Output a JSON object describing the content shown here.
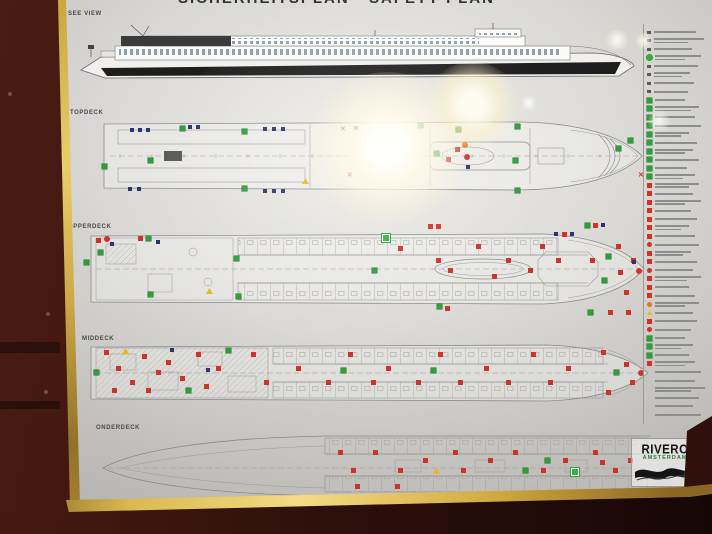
{
  "poster": {
    "title": "SICHERHEITSPLAN · SAFETY PLAN",
    "side_view_label": "SEE VIEW",
    "logo": {
      "line1": "RIVERO",
      "line2": "AMSTERDAM"
    },
    "decks": [
      {
        "id": "topdeck",
        "label": "TOPDECK",
        "icons": [
          [
            "b",
            30,
            10
          ],
          [
            "b",
            38,
            10
          ],
          [
            "b",
            46,
            10
          ],
          [
            "g",
            80,
            8
          ],
          [
            "b",
            88,
            7
          ],
          [
            "b",
            96,
            7
          ],
          [
            "g",
            142,
            11
          ],
          [
            "b",
            163,
            9
          ],
          [
            "b",
            172,
            9
          ],
          [
            "b",
            181,
            9
          ],
          [
            "x",
            240,
            8
          ],
          [
            "b",
            254,
            8
          ],
          [
            "g",
            318,
            5
          ],
          [
            "g",
            356,
            9
          ],
          [
            "g",
            415,
            6
          ],
          [
            "o",
            362,
            24
          ],
          [
            "R",
            364,
            36
          ],
          [
            "b",
            366,
            47
          ],
          [
            "g",
            334,
            33
          ],
          [
            "r",
            346,
            39
          ],
          [
            "r",
            355,
            29
          ],
          [
            "g",
            415,
            70
          ],
          [
            "g",
            142,
            68
          ],
          [
            "b",
            28,
            69
          ],
          [
            "b",
            37,
            69
          ],
          [
            "b",
            163,
            71
          ],
          [
            "b",
            172,
            71
          ],
          [
            "b",
            181,
            71
          ],
          [
            "y",
            202,
            60
          ],
          [
            "g",
            2,
            46
          ],
          [
            "g",
            48,
            40
          ],
          [
            "x",
            247,
            54
          ],
          [
            "g",
            516,
            28
          ],
          [
            "g",
            413,
            40
          ],
          [
            "g",
            528,
            20
          ],
          [
            "x",
            538,
            54
          ]
        ]
      },
      {
        "id": "opperdeck",
        "label": "OPPERDECK",
        "icons": [
          [
            "r",
            8,
            8
          ],
          [
            "R",
            16,
            6
          ],
          [
            "g",
            10,
            20
          ],
          [
            "b",
            22,
            12
          ],
          [
            "r",
            50,
            6
          ],
          [
            "g",
            58,
            6
          ],
          [
            "b",
            68,
            10
          ],
          [
            "g",
            60,
            62
          ],
          [
            "g",
            -4,
            30
          ],
          [
            "y",
            118,
            58
          ],
          [
            "g",
            146,
            26
          ],
          [
            "g",
            148,
            64
          ],
          [
            "G",
            294,
            4
          ],
          [
            "r",
            310,
            16
          ],
          [
            "r",
            348,
            28
          ],
          [
            "r",
            388,
            14
          ],
          [
            "r",
            418,
            28
          ],
          [
            "r",
            452,
            14
          ],
          [
            "r",
            468,
            28
          ],
          [
            "r",
            502,
            28
          ],
          [
            "r",
            528,
            14
          ],
          [
            "r",
            543,
            28
          ],
          [
            "b",
            466,
            2
          ],
          [
            "r",
            474,
            2
          ],
          [
            "b",
            482,
            2
          ],
          [
            "r",
            340,
            -6
          ],
          [
            "r",
            348,
            -6
          ],
          [
            "g",
            497,
            -7
          ],
          [
            "r",
            505,
            -7
          ],
          [
            "b",
            513,
            -7
          ],
          [
            "g",
            349,
            74
          ],
          [
            "r",
            357,
            76
          ],
          [
            "r",
            520,
            80
          ],
          [
            "g",
            500,
            80
          ],
          [
            "r",
            538,
            80
          ],
          [
            "g",
            514,
            48
          ],
          [
            "r",
            530,
            40
          ],
          [
            "r",
            536,
            60
          ],
          [
            "b",
            544,
            30
          ],
          [
            "R",
            548,
            38
          ],
          [
            "g",
            518,
            24
          ],
          [
            "r",
            360,
            38
          ],
          [
            "g",
            284,
            38
          ],
          [
            "r",
            404,
            44
          ],
          [
            "r",
            440,
            38
          ]
        ]
      },
      {
        "id": "middeck",
        "label": "MIDDECK",
        "icons": [
          [
            "r",
            16,
            8
          ],
          [
            "r",
            28,
            24
          ],
          [
            "r",
            42,
            38
          ],
          [
            "r",
            54,
            12
          ],
          [
            "r",
            68,
            28
          ],
          [
            "r",
            24,
            46
          ],
          [
            "r",
            58,
            46
          ],
          [
            "r",
            78,
            18
          ],
          [
            "r",
            92,
            34
          ],
          [
            "r",
            108,
            10
          ],
          [
            "r",
            116,
            42
          ],
          [
            "r",
            128,
            24
          ],
          [
            "g",
            6,
            28
          ],
          [
            "g",
            98,
            46
          ],
          [
            "g",
            138,
            6
          ],
          [
            "y",
            34,
            6
          ],
          [
            "b",
            82,
            6
          ],
          [
            "b",
            118,
            26
          ],
          [
            "r",
            163,
            10
          ],
          [
            "r",
            176,
            38
          ],
          [
            "r",
            208,
            24
          ],
          [
            "r",
            238,
            38
          ],
          [
            "r",
            260,
            10
          ],
          [
            "r",
            283,
            38
          ],
          [
            "r",
            298,
            24
          ],
          [
            "r",
            328,
            38
          ],
          [
            "r",
            350,
            10
          ],
          [
            "r",
            370,
            38
          ],
          [
            "r",
            396,
            24
          ],
          [
            "r",
            418,
            38
          ],
          [
            "r",
            443,
            10
          ],
          [
            "r",
            460,
            38
          ],
          [
            "r",
            478,
            24
          ],
          [
            "g",
            253,
            26
          ],
          [
            "g",
            343,
            26
          ],
          [
            "r",
            513,
            8
          ],
          [
            "g",
            526,
            28
          ],
          [
            "r",
            518,
            48
          ],
          [
            "r",
            536,
            20
          ],
          [
            "r",
            542,
            38
          ],
          [
            "R",
            550,
            28
          ]
        ]
      },
      {
        "id": "onderdeck",
        "label": "ONDERDECK",
        "icons": [
          [
            "r",
            243,
            20
          ],
          [
            "r",
            256,
            38
          ],
          [
            "r",
            278,
            20
          ],
          [
            "r",
            303,
            38
          ],
          [
            "r",
            328,
            28
          ],
          [
            "r",
            358,
            20
          ],
          [
            "r",
            366,
            38
          ],
          [
            "r",
            393,
            28
          ],
          [
            "r",
            418,
            20
          ],
          [
            "r",
            446,
            38
          ],
          [
            "r",
            468,
            28
          ],
          [
            "r",
            498,
            20
          ],
          [
            "r",
            505,
            30
          ],
          [
            "r",
            518,
            38
          ],
          [
            "r",
            533,
            28
          ],
          [
            "g",
            428,
            38
          ],
          [
            "g",
            450,
            28
          ],
          [
            "G",
            476,
            38
          ],
          [
            "y",
            338,
            38
          ],
          [
            "r",
            260,
            54
          ],
          [
            "r",
            300,
            54
          ]
        ]
      }
    ],
    "legend": {
      "rows": [
        {
          "t": "d",
          "w": 42
        },
        {
          "t": "d",
          "w": 50,
          "w2": 34
        },
        {
          "t": "d",
          "w": 38
        },
        {
          "t": "G",
          "w": 46,
          "w2": 30
        },
        {
          "t": "d",
          "w": 44
        },
        {
          "t": "d",
          "w": 36,
          "w2": 28
        },
        {
          "t": "d",
          "w": 40
        },
        {
          "t": "d",
          "w": 34
        },
        {
          "t": "g",
          "w": 30
        },
        {
          "t": "g",
          "w": 44,
          "w2": 36
        },
        {
          "t": "g",
          "w": 40
        },
        {
          "t": "g",
          "w": 46
        },
        {
          "t": "g",
          "w": 34,
          "w2": 26
        },
        {
          "t": "g",
          "w": 42
        },
        {
          "t": "g",
          "w": 38,
          "w2": 30
        },
        {
          "t": "g",
          "w": 44
        },
        {
          "t": "g",
          "w": 32
        },
        {
          "t": "g",
          "w": 40,
          "w2": 28
        },
        {
          "t": "r",
          "w": 44,
          "w2": 34
        },
        {
          "t": "r",
          "w": 38
        },
        {
          "t": "r",
          "w": 46,
          "w2": 30
        },
        {
          "t": "r",
          "w": 36
        },
        {
          "t": "r",
          "w": 42
        },
        {
          "t": "r",
          "w": 34,
          "w2": 26
        },
        {
          "t": "r",
          "w": 40
        },
        {
          "t": "R",
          "w": 44
        },
        {
          "t": "r",
          "w": 36,
          "w2": 28
        },
        {
          "t": "r",
          "w": 42
        },
        {
          "t": "R",
          "w": 38
        },
        {
          "t": "r",
          "w": 46,
          "w2": 32
        },
        {
          "t": "r",
          "w": 34
        },
        {
          "t": "r",
          "w": 40
        },
        {
          "t": "o",
          "w": 44,
          "w2": 30
        },
        {
          "t": "y",
          "w": 38
        },
        {
          "t": "r",
          "w": 42
        },
        {
          "t": "R",
          "w": 36
        },
        {
          "t": "g",
          "w": 30
        },
        {
          "t": "g",
          "w": 38,
          "w2": 26
        },
        {
          "t": "g",
          "w": 34
        },
        {
          "t": "r",
          "w": 40,
          "w2": 30
        },
        {
          "t": "n",
          "w": 46
        },
        {
          "t": "n",
          "w": 40
        },
        {
          "t": "n",
          "w": 50,
          "w2": 36
        },
        {
          "t": "n",
          "w": 44
        },
        {
          "t": "n",
          "w": 38
        },
        {
          "t": "n",
          "w": 46
        }
      ]
    },
    "colors": {
      "safety_green": "#2e9e3a",
      "safety_red": "#cf3227",
      "frame_gold": "#d9b84e",
      "wood": "#4a1c13",
      "paper": "#dcdbd7"
    }
  }
}
